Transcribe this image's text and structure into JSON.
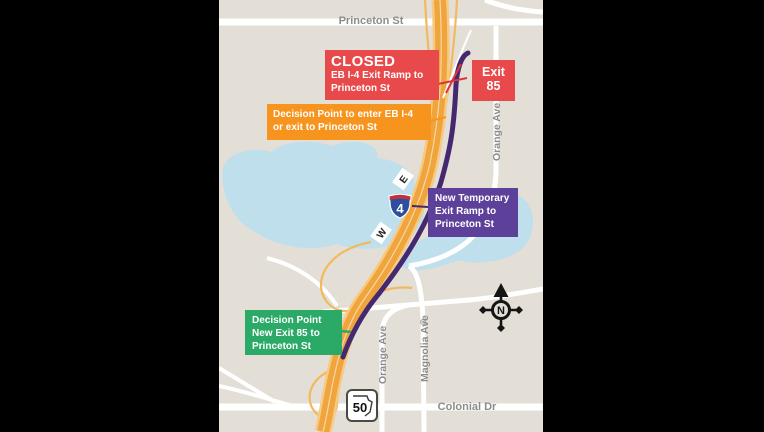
{
  "page": {
    "background": "#000000"
  },
  "map": {
    "background": "#E3DFD6",
    "colors": {
      "road_white": "#FFFFFF",
      "water_blue": "#BFDFEC",
      "highway_orange": "#F0A43C",
      "highway_edge_orange": "#F7C983",
      "route_purple": "#45286F",
      "closed_red": "#E8494B",
      "decision_orange": "#F7941E",
      "temporary_purple": "#5C4099",
      "new_exit_green": "#2BA966",
      "street_label_gray": "#8C8C8C",
      "compass_black": "#151515",
      "interstate_blue": "#2D4E9E",
      "interstate_red": "#C6303E"
    },
    "street_labels": {
      "princeton": "Princeton St",
      "orange_top": "Orange Ave",
      "orange_bottom": "Orange Ave",
      "magnolia": "Magnolia Ave",
      "colonial": "Colonial Dr"
    },
    "shields": {
      "interstate_number": "4",
      "eastbound": "E",
      "westbound": "W",
      "state_route_number": "50"
    },
    "compass_label": "N"
  },
  "callouts": {
    "closed": {
      "title": "CLOSED",
      "lines": [
        "EB I-4 Exit Ramp to",
        "Princeton St"
      ]
    },
    "exit_85": {
      "lines": [
        "Exit",
        "85"
      ]
    },
    "decision_enter": {
      "lines": [
        "Decision Point to enter EB I-4",
        "or exit to Princeton St"
      ]
    },
    "temporary_ramp": {
      "lines": [
        "New Temporary",
        "Exit Ramp to",
        "Princeton St"
      ]
    },
    "decision_new_exit": {
      "lines": [
        "Decision Point",
        "New Exit 85 to",
        "Princeton St"
      ]
    }
  }
}
